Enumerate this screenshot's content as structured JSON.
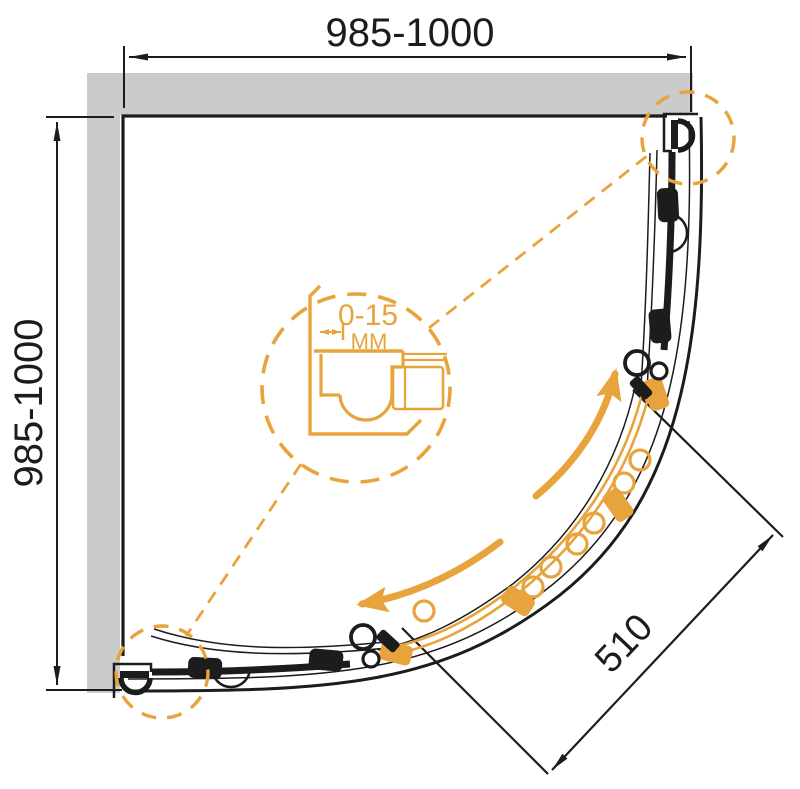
{
  "drawing": {
    "title": "Quarter-round shower enclosure — plan view technical drawing",
    "dim_top": "985-1000",
    "dim_left": "985-1000",
    "dim_diagonal": "510",
    "detail_value": "0-15",
    "detail_unit": "MM"
  },
  "colors": {
    "accent": "#E8A43C",
    "line": "#1C1C1C",
    "wall": "#CBCBCB",
    "bg": "#FFFFFF"
  }
}
